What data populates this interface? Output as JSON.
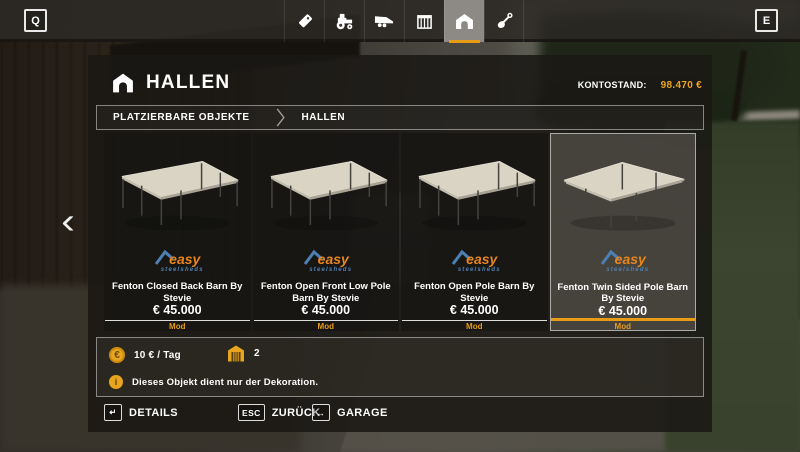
{
  "colors": {
    "accent": "#e79b16",
    "brand_orange": "#e8851c",
    "brand_blue": "#4d7fb3"
  },
  "topbar": {
    "left_key": "Q",
    "right_key": "E",
    "tabs": [
      {
        "name": "price-tag-icon",
        "selected": false
      },
      {
        "name": "tractor-icon",
        "selected": false
      },
      {
        "name": "trailer-icon",
        "selected": false
      },
      {
        "name": "pallet-box-icon",
        "selected": false
      },
      {
        "name": "barn-icon",
        "selected": true
      },
      {
        "name": "shovel-icon",
        "selected": false
      }
    ]
  },
  "header": {
    "icon": "barn-icon",
    "title": "HALLEN",
    "balance_label": "KONTOSTAND:",
    "balance_value": "98.470 €"
  },
  "breadcrumb": {
    "items": [
      {
        "label": "PLATZIERBARE OBJEKTE"
      },
      {
        "label": "HALLEN"
      }
    ]
  },
  "nav": {
    "prev_glyph": "‹"
  },
  "brand": {
    "line1": "easy",
    "line2": "steelsheds"
  },
  "items": [
    {
      "title": "Fenton Closed Back Barn By Stevie",
      "price": "€ 45.000",
      "badge": "Mod",
      "selected": false
    },
    {
      "title": "Fenton Open Front Low Pole Barn By Stevie",
      "price": "€ 45.000",
      "badge": "Mod",
      "selected": false
    },
    {
      "title": "Fenton Open Pole Barn By Stevie",
      "price": "€ 45.000",
      "badge": "Mod",
      "selected": false
    },
    {
      "title": "Fenton Twin Sided Pole Barn By Stevie",
      "price": "€ 45.000",
      "badge": "Mod",
      "selected": true
    }
  ],
  "info": {
    "coin_glyph": "€",
    "daily_cost": "10 € / Tag",
    "owned_count": "2",
    "info_glyph": "i",
    "note": "Dieses Objekt dient nur der Dekoration."
  },
  "actions": [
    {
      "key": "↵",
      "label": "DETAILS"
    },
    {
      "key": "ESC",
      "label": "ZURÜCK"
    },
    {
      "key": "↔",
      "label": "GARAGE"
    }
  ]
}
